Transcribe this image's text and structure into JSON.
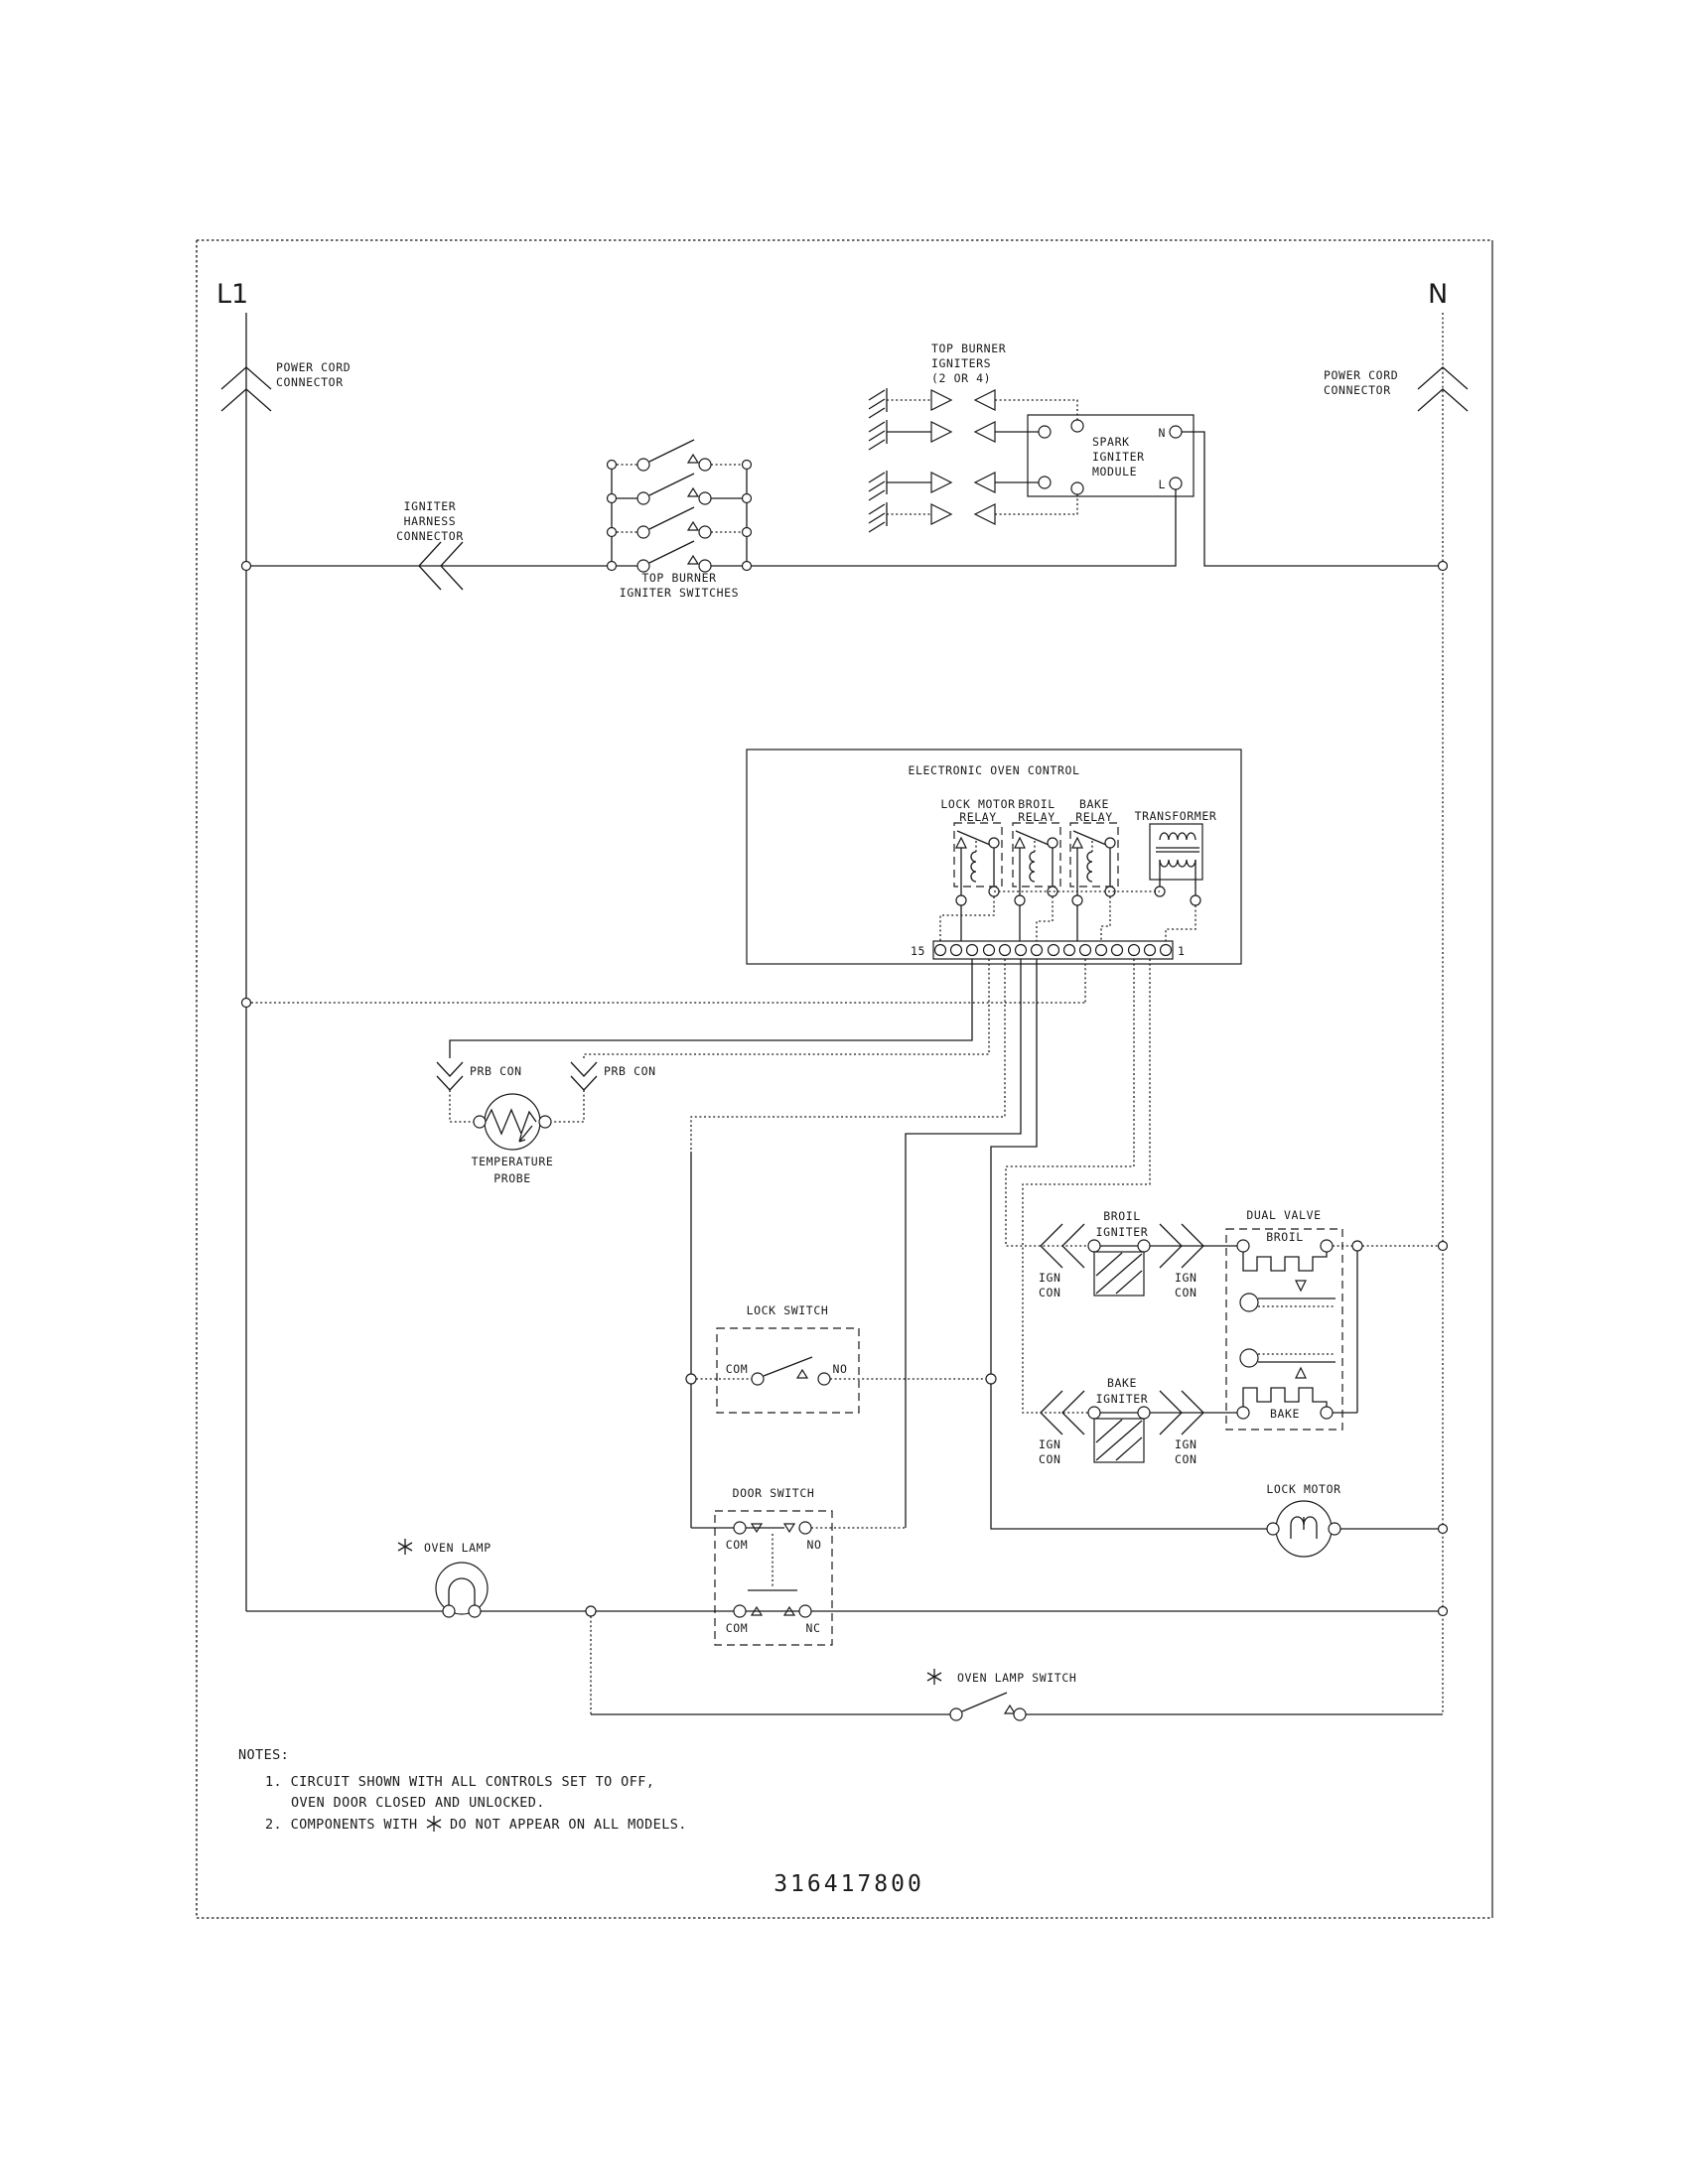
{
  "colors": {
    "line": "#1a1a1a",
    "background": "#ffffff"
  },
  "diagram": {
    "part_number": "316417800",
    "left_rail": {
      "label": "L1",
      "connector": [
        "POWER CORD",
        "CONNECTOR"
      ]
    },
    "right_rail": {
      "label": "N",
      "connector": [
        "POWER CORD",
        "CONNECTOR"
      ]
    },
    "igniter_harness": [
      "IGNITER",
      "HARNESS",
      "CONNECTOR"
    ],
    "top_burner_switches": [
      "TOP BURNER",
      "IGNITER SWITCHES"
    ],
    "top_burner_igniters": [
      "TOP BURNER",
      "IGNITERS",
      "(2 OR 4)"
    ],
    "spark_module": {
      "title": [
        "SPARK",
        "IGNITER",
        "MODULE"
      ],
      "terminal_n": "N",
      "terminal_l": "L"
    },
    "eoc": {
      "title": "ELECTRONIC OVEN CONTROL",
      "relays": [
        [
          "LOCK MOTOR",
          "RELAY"
        ],
        [
          "BROIL",
          "RELAY"
        ],
        [
          "BAKE",
          "RELAY"
        ]
      ],
      "transformer": "TRANSFORMER",
      "strip_left": "15",
      "strip_right": "1"
    },
    "probe": {
      "connector": "PRB CON",
      "label": [
        "TEMPERATURE",
        "PROBE"
      ]
    },
    "lock_switch": {
      "title": "LOCK SWITCH",
      "com": "COM",
      "no": "NO"
    },
    "door_switch": {
      "title": "DOOR SWITCH",
      "upper": {
        "com": "COM",
        "no": "NO"
      },
      "lower": {
        "com": "COM",
        "nc": "NC"
      }
    },
    "broil_igniter": {
      "label": [
        "BROIL",
        "IGNITER"
      ],
      "ign_con": [
        "IGN",
        "CON"
      ]
    },
    "bake_igniter": {
      "label": [
        "BAKE",
        "IGNITER"
      ],
      "ign_con": [
        "IGN",
        "CON"
      ]
    },
    "dual_valve": {
      "title": "DUAL VALVE",
      "broil": "BROIL",
      "bake": "BAKE"
    },
    "lock_motor": "LOCK MOTOR",
    "oven_lamp": "OVEN LAMP",
    "oven_lamp_switch": "OVEN LAMP SWITCH",
    "notes": {
      "heading": "NOTES:",
      "n1a": "1.  CIRCUIT SHOWN WITH ALL CONTROLS SET TO OFF,",
      "n1b": "OVEN DOOR CLOSED AND UNLOCKED.",
      "n2a": "2.  COMPONENTS WITH",
      "n2b": "DO NOT APPEAR ON ALL MODELS."
    }
  }
}
